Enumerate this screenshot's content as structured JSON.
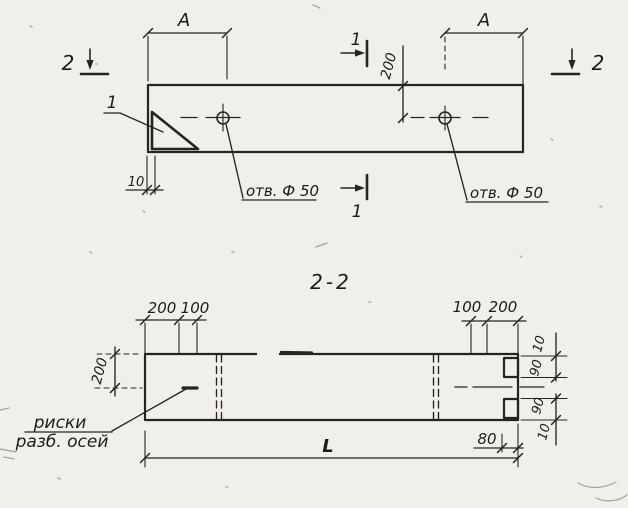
{
  "plan": {
    "marker1_top": "1",
    "marker1_bottom": "1",
    "marker2_left": "2",
    "marker2_right": "2",
    "detail1": "1",
    "dim_a_left": "A",
    "dim_a_right": "A",
    "dim_200": "200",
    "dim_10": "10",
    "hole_left": "отв. Ф 50",
    "hole_right": "отв. Ф 50"
  },
  "section": {
    "title": "2-2",
    "dim_200_left_top": "200",
    "dim_100_left_top": "100",
    "dim_100_right_top": "100",
    "dim_200_right_top": "200",
    "dim_200_side": "200",
    "dim_10_a": "10",
    "dim_90_a": "90",
    "dim_90_b": "90",
    "dim_10_b": "10",
    "dim_80": "80",
    "dim_L": "L",
    "axis_note_line1": "риски",
    "axis_note_line2": "разб. осей"
  }
}
